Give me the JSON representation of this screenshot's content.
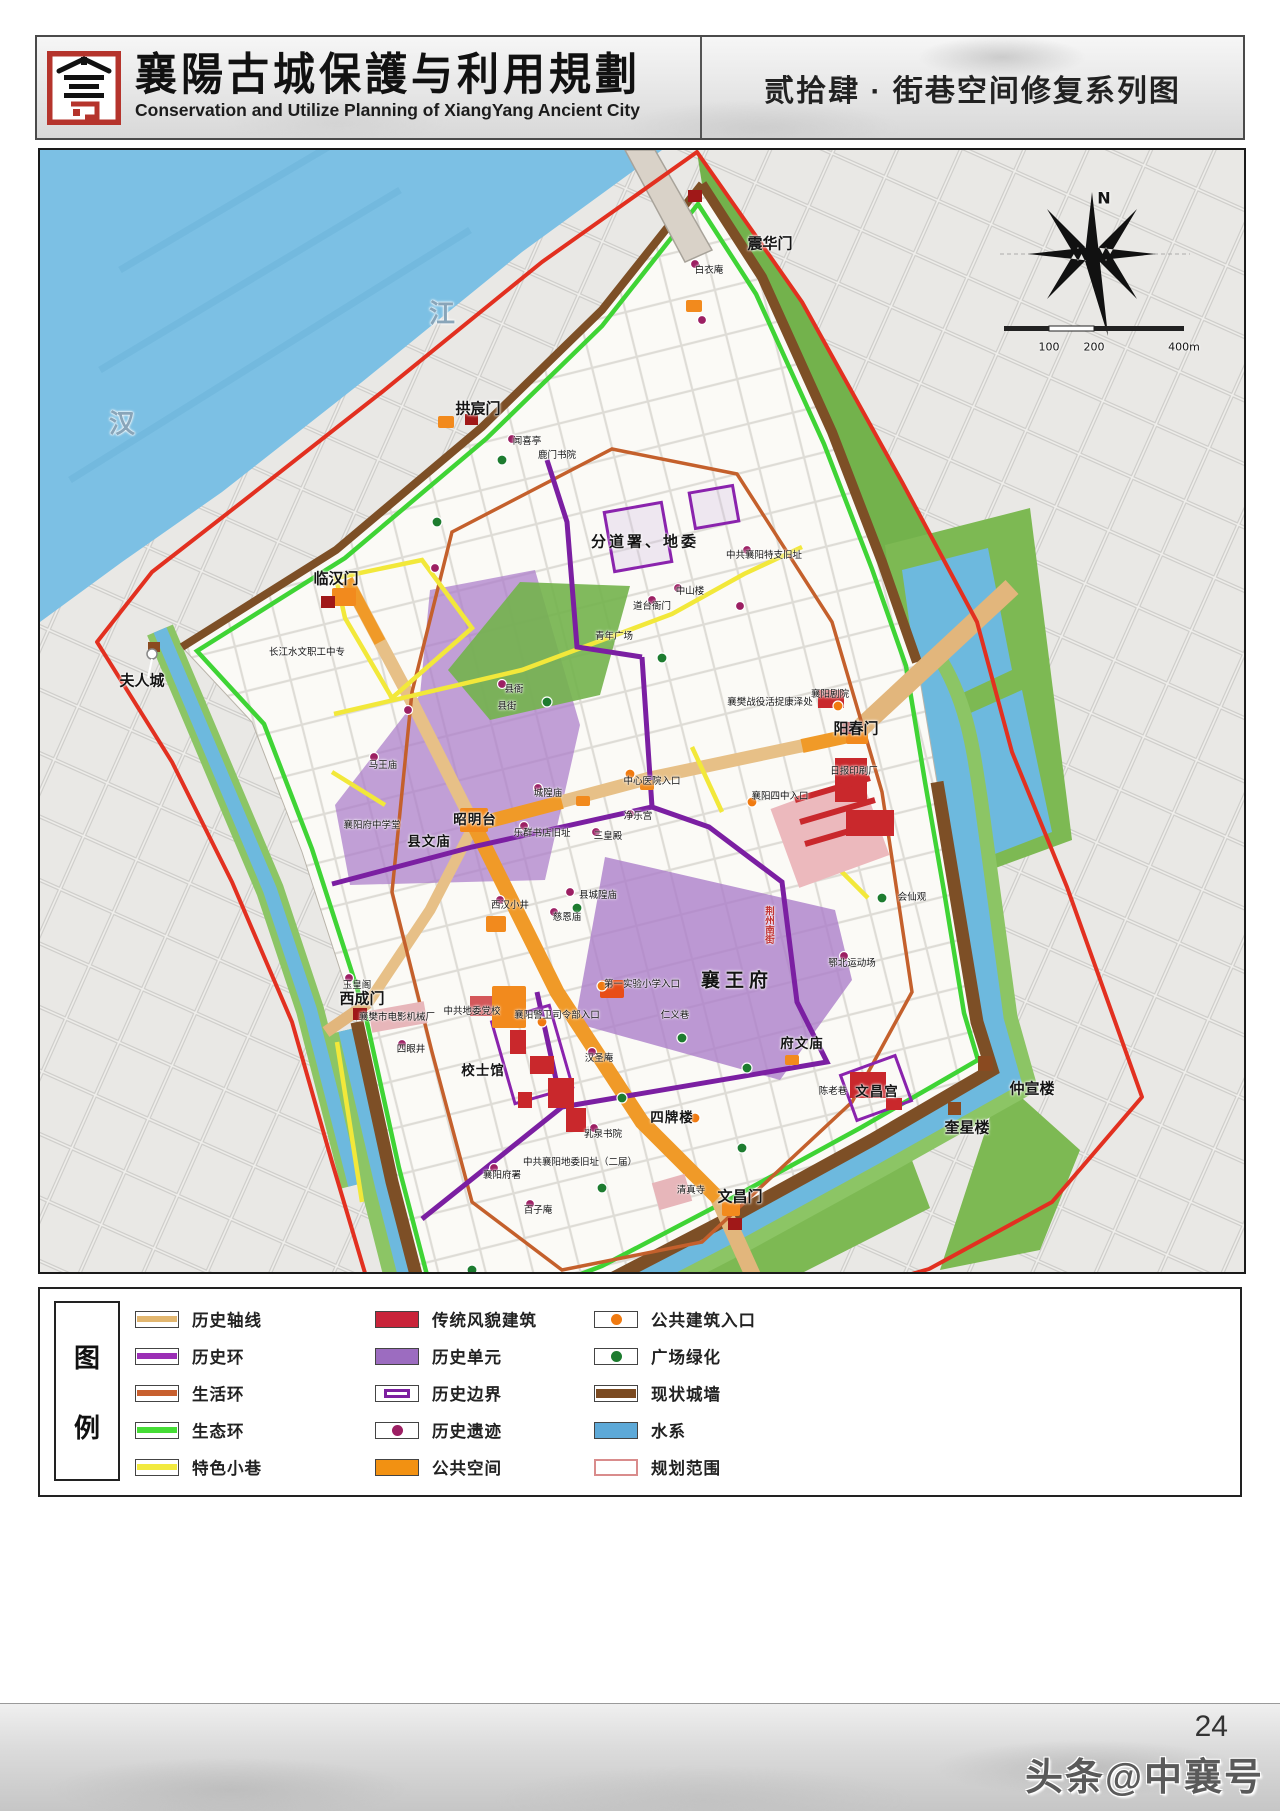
{
  "header": {
    "logo_name": "xiangyang-city-emblem",
    "title_cn": "襄陽古城保護与利用規劃",
    "title_en": "Conservation and Utilize Planning of XiangYang Ancient City",
    "sheet_title": "贰拾肆 · 街巷空间修复系列图"
  },
  "map": {
    "labels": [
      {
        "t": "震华门",
        "x": 730,
        "y": 93,
        "c": "gate"
      },
      {
        "t": "拱宸门",
        "x": 438,
        "y": 258,
        "c": "gate"
      },
      {
        "t": "临汉门",
        "x": 296,
        "y": 428,
        "c": "gate"
      },
      {
        "t": "夫人城",
        "x": 102,
        "y": 530,
        "c": "gate"
      },
      {
        "t": "西成门",
        "x": 322,
        "y": 848,
        "c": "gate"
      },
      {
        "t": "阳春门",
        "x": 816,
        "y": 578,
        "c": "gate"
      },
      {
        "t": "文昌门",
        "x": 700,
        "y": 1046,
        "c": "gate"
      },
      {
        "t": "仲宣楼",
        "x": 992,
        "y": 938,
        "c": "gate"
      },
      {
        "t": "奎星楼",
        "x": 927,
        "y": 977,
        "c": "gate"
      },
      {
        "t": "狮子楼",
        "x": 403,
        "y": 1165,
        "c": "gate"
      },
      {
        "t": "分道署、地委",
        "x": 605,
        "y": 391,
        "c": "major"
      },
      {
        "t": "襄王府",
        "x": 697,
        "y": 829,
        "c": "major-lg"
      },
      {
        "t": "昭明台",
        "x": 435,
        "y": 668,
        "c": "site"
      },
      {
        "t": "县文庙",
        "x": 389,
        "y": 690,
        "c": "site"
      },
      {
        "t": "校士馆",
        "x": 443,
        "y": 919,
        "c": "site"
      },
      {
        "t": "四牌楼",
        "x": 632,
        "y": 966,
        "c": "site"
      },
      {
        "t": "府文庙",
        "x": 762,
        "y": 892,
        "c": "site"
      },
      {
        "t": "文昌宫",
        "x": 837,
        "y": 940,
        "c": "site"
      },
      {
        "t": "白衣庵",
        "x": 669,
        "y": 119,
        "c": "minor"
      },
      {
        "t": "闻喜亭",
        "x": 487,
        "y": 290,
        "c": "minor"
      },
      {
        "t": "鹿门书院",
        "x": 517,
        "y": 304,
        "c": "minor"
      },
      {
        "t": "中共襄阳特支旧址",
        "x": 724,
        "y": 404,
        "c": "minor"
      },
      {
        "t": "中山楼",
        "x": 650,
        "y": 440,
        "c": "minor"
      },
      {
        "t": "道台衙门",
        "x": 612,
        "y": 455,
        "c": "minor"
      },
      {
        "t": "青年广场",
        "x": 574,
        "y": 485,
        "c": "minor"
      },
      {
        "t": "长江水文职工中专",
        "x": 267,
        "y": 501,
        "c": "minor"
      },
      {
        "t": "县衙",
        "x": 474,
        "y": 538,
        "c": "minor"
      },
      {
        "t": "县街",
        "x": 467,
        "y": 555,
        "c": "minor"
      },
      {
        "t": "襄阳剧院",
        "x": 790,
        "y": 543,
        "c": "minor"
      },
      {
        "t": "襄樊战役活捉康泽处",
        "x": 730,
        "y": 551,
        "c": "minor"
      },
      {
        "t": "马王庙",
        "x": 343,
        "y": 614,
        "c": "minor"
      },
      {
        "t": "中心医院入口",
        "x": 612,
        "y": 630,
        "c": "minor"
      },
      {
        "t": "襄阳四中入口",
        "x": 740,
        "y": 645,
        "c": "minor"
      },
      {
        "t": "城隍庙",
        "x": 508,
        "y": 642,
        "c": "minor"
      },
      {
        "t": "净乐宫",
        "x": 598,
        "y": 665,
        "c": "minor"
      },
      {
        "t": "三皇殿",
        "x": 568,
        "y": 685,
        "c": "minor"
      },
      {
        "t": "乐群书店旧址",
        "x": 502,
        "y": 682,
        "c": "minor"
      },
      {
        "t": "襄阳府中学堂",
        "x": 332,
        "y": 674,
        "c": "minor"
      },
      {
        "t": "县城隍庙",
        "x": 558,
        "y": 744,
        "c": "minor"
      },
      {
        "t": "慈恩庙",
        "x": 527,
        "y": 766,
        "c": "minor"
      },
      {
        "t": "西汉小井",
        "x": 470,
        "y": 754,
        "c": "minor"
      },
      {
        "t": "会仙观",
        "x": 872,
        "y": 746,
        "c": "minor"
      },
      {
        "t": "鄂北运动场",
        "x": 812,
        "y": 812,
        "c": "minor"
      },
      {
        "t": "日报印刷厂",
        "x": 814,
        "y": 620,
        "c": "minor"
      },
      {
        "t": "第一实验小学入口",
        "x": 602,
        "y": 833,
        "c": "minor"
      },
      {
        "t": "襄阳警卫司令部入口",
        "x": 517,
        "y": 864,
        "c": "minor"
      },
      {
        "t": "中共地委党校",
        "x": 432,
        "y": 860,
        "c": "minor"
      },
      {
        "t": "襄樊市电影机械厂",
        "x": 357,
        "y": 866,
        "c": "minor"
      },
      {
        "t": "玉皇阁",
        "x": 317,
        "y": 834,
        "c": "minor"
      },
      {
        "t": "四眼井",
        "x": 371,
        "y": 898,
        "c": "minor"
      },
      {
        "t": "汉圣庵",
        "x": 559,
        "y": 907,
        "c": "minor"
      },
      {
        "t": "仁义巷",
        "x": 635,
        "y": 864,
        "c": "minor"
      },
      {
        "t": "乳泉书院",
        "x": 563,
        "y": 983,
        "c": "minor"
      },
      {
        "t": "襄阳府署",
        "x": 462,
        "y": 1024,
        "c": "minor"
      },
      {
        "t": "中共襄阳地委旧址（二届）",
        "x": 540,
        "y": 1011,
        "c": "minor"
      },
      {
        "t": "百子庵",
        "x": 498,
        "y": 1059,
        "c": "minor"
      },
      {
        "t": "清真寺",
        "x": 651,
        "y": 1039,
        "c": "minor"
      },
      {
        "t": "陈老巷",
        "x": 793,
        "y": 940,
        "c": "minor"
      },
      {
        "t": "荆州南街",
        "x": 728,
        "y": 775,
        "c": "street-v"
      },
      {
        "t": "江",
        "x": 402,
        "y": 162,
        "c": "river"
      },
      {
        "t": "汉",
        "x": 82,
        "y": 272,
        "c": "river"
      },
      {
        "t": "N",
        "x": 1064,
        "y": 48,
        "c": "compass"
      },
      {
        "t": "100",
        "x": 1009,
        "y": 197,
        "c": "scalet"
      },
      {
        "t": "200",
        "x": 1054,
        "y": 197,
        "c": "scalet"
      },
      {
        "t": "400m",
        "x": 1144,
        "y": 197,
        "c": "scalet"
      }
    ]
  },
  "legend": {
    "title_top": "图",
    "title_bottom": "例",
    "columns": [
      [
        {
          "label": "历史轴线",
          "sw": "band",
          "color": "#e2b66f"
        },
        {
          "label": "历史环",
          "sw": "band",
          "color": "#9b2fb5"
        },
        {
          "label": "生活环",
          "sw": "band",
          "color": "#c8602f"
        },
        {
          "label": "生态环",
          "sw": "band",
          "color": "#45dd35"
        },
        {
          "label": "特色小巷",
          "sw": "band",
          "color": "#f2ea3e"
        }
      ],
      [
        {
          "label": "传统风貌建筑",
          "sw": "fill",
          "color": "#c9243a"
        },
        {
          "label": "历史单元",
          "sw": "fill",
          "color": "#9c6cc0"
        },
        {
          "label": "历史边界",
          "sw": "border",
          "color": "#7d1fa0"
        },
        {
          "label": "历史遗迹",
          "sw": "dot",
          "color": "#9c1f63"
        },
        {
          "label": "公共空间",
          "sw": "fill",
          "color": "#f29112"
        }
      ],
      [
        {
          "label": "公共建筑入口",
          "sw": "dot",
          "color": "#f07a10"
        },
        {
          "label": "广场绿化",
          "sw": "dot",
          "color": "#1d7c2f"
        },
        {
          "label": "现状城墙",
          "sw": "wall",
          "color": "#7b4a21"
        },
        {
          "label": "水系",
          "sw": "fill",
          "color": "#5da9d8"
        },
        {
          "label": "规划范围",
          "sw": "outline",
          "color": "#d98c8c"
        }
      ]
    ]
  },
  "footer": {
    "page_number": "24",
    "watermark": "头条@中襄号"
  }
}
